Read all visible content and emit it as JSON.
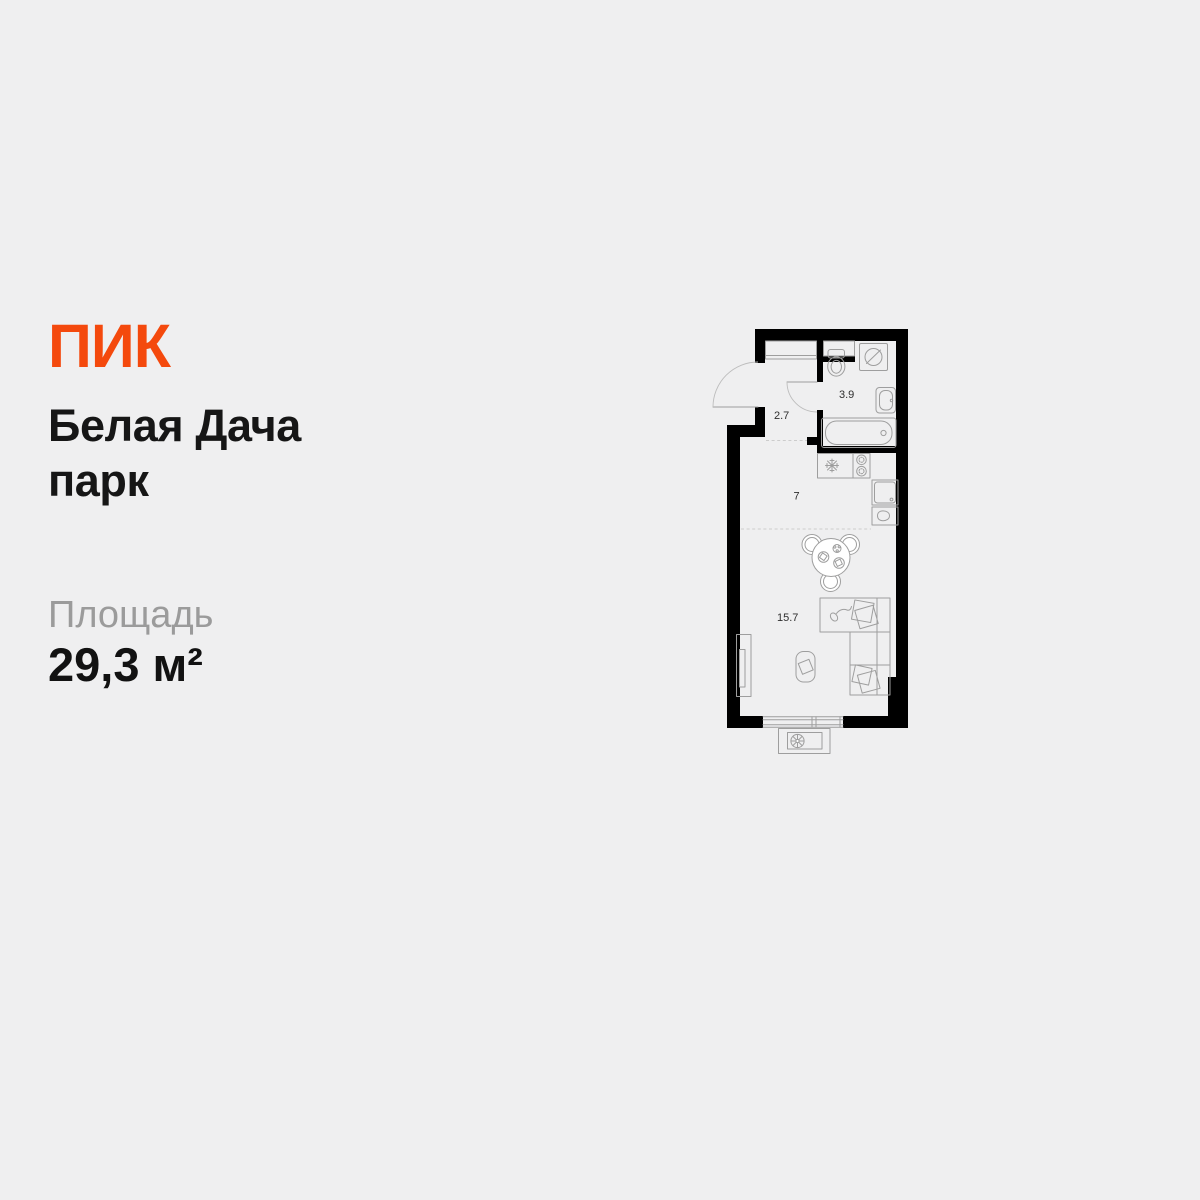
{
  "card": {
    "background_color": "#efeff0",
    "logo": {
      "text": "ПИК",
      "color": "#F4490D"
    },
    "title_lines": [
      "Белая Дача",
      "парк"
    ],
    "area": {
      "label": "Площадь",
      "value": "29,3 м²"
    }
  },
  "plan": {
    "wall_color": "#000000",
    "outline_color": "#9e9e9e",
    "rooms": [
      {
        "id": "hallway",
        "area": "2.7"
      },
      {
        "id": "bathroom",
        "area": "3.9"
      },
      {
        "id": "kitchen",
        "area": "7"
      },
      {
        "id": "living-room",
        "area": "15.7"
      }
    ],
    "fixtures": [
      "entrance-door",
      "bathroom-door",
      "wardrobe",
      "vent-shaft",
      "washing-machine",
      "toilet",
      "bathroom-sink",
      "bathtub",
      "kitchen-sink",
      "stove-burners",
      "counter-sink",
      "kettle",
      "dining-table",
      "chairs",
      "desk",
      "computer-mouse",
      "papers",
      "bed",
      "pillows",
      "tv-stand",
      "pouf",
      "window",
      "balcony",
      "ac-unit"
    ]
  }
}
